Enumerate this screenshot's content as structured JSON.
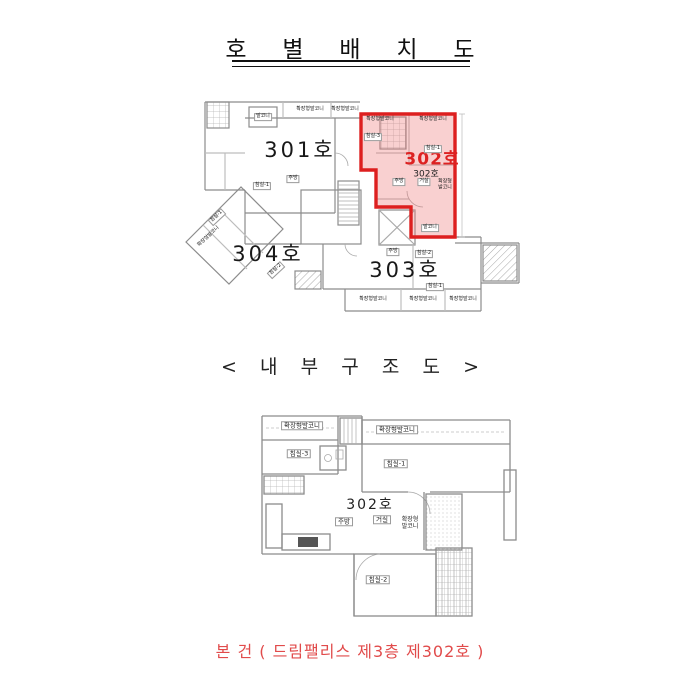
{
  "page": {
    "title": "호 별 배 치 도",
    "subtitle": "< 내 부 구 조 도 >",
    "footer": "본 건 ( 드림팰리스 제3층 제302호 )"
  },
  "colors": {
    "highlight_border": "#dd1f1f",
    "highlight_fill": "rgba(238,120,120,0.35)",
    "highlight_label": "#dd2222",
    "footer_text": "#e14b4b",
    "wall_line": "#8c8c8c"
  },
  "site_plan": {
    "caption": "호별배치도(3층 평면)",
    "units": {
      "u301": {
        "label": "301호"
      },
      "u302": {
        "label_red": "302호",
        "label_black": "302호",
        "highlighted": true
      },
      "u303": {
        "label": "303호"
      },
      "u304": {
        "label": "304호"
      }
    },
    "rooms": {
      "balcony_tl": "발코니",
      "ext_top1": "확장형발코니",
      "ext_top2": "확장형발코니",
      "ext_302_tl": "확장형발코니",
      "ext_302_tr": "확장형발코니",
      "bed3_302": "침실-3",
      "bed1_302": "침실-1",
      "kitchen_302": "주방",
      "living_302": "거실",
      "extb_302_r": "확장형 발코니",
      "balcony_302": "발코니",
      "bed1_301": "침실-1",
      "kitchen_301": "주방",
      "kitchen_303": "주방",
      "bed2_303": "침실-2",
      "bed1_303": "침실-1",
      "ext_303_1": "확장형발코니",
      "ext_303_2": "확장형발코니",
      "ext_303_3": "확장형발코니",
      "bed1_304": "침실-1",
      "ext_304": "확장형발코니",
      "bed2_304": "침실-2"
    }
  },
  "unit_plan": {
    "unit_label": "302호",
    "rooms": {
      "ext_balcony_left": "확장형발코니",
      "bed3": "침실-3",
      "ext_balcony_right": "확장형발코니",
      "bed1": "침실-1",
      "kitchen": "주방",
      "living": "거실",
      "ext_balcony_side": "확장형 발코니",
      "bed2": "침실-2"
    }
  }
}
